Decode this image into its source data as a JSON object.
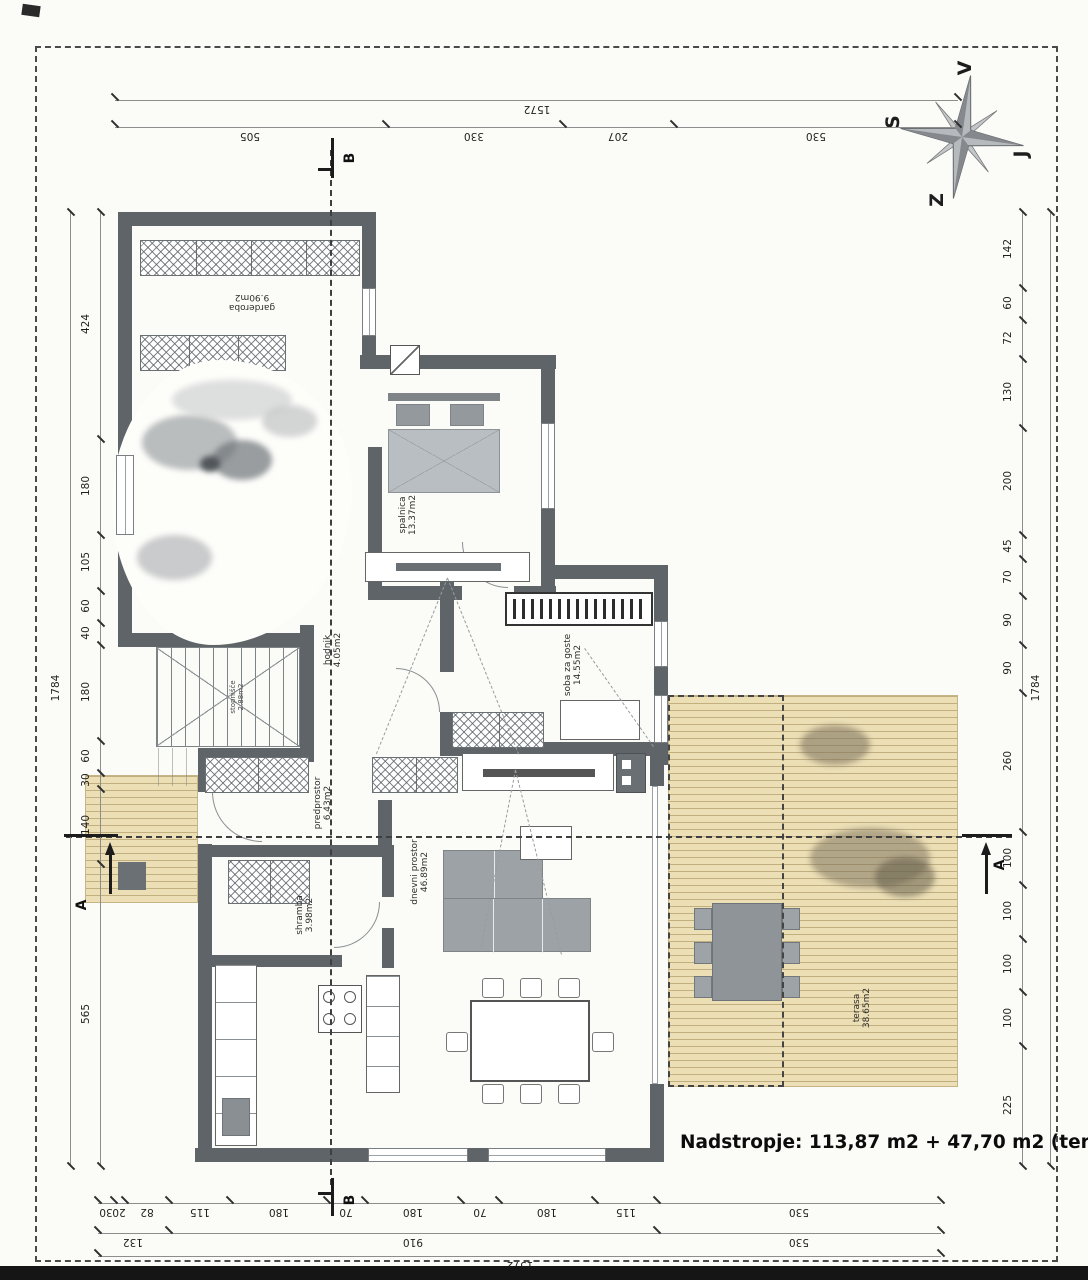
{
  "compass": {
    "v": "V",
    "s": "S",
    "j": "J",
    "z": "Z"
  },
  "dims": {
    "top_total": [
      "1572"
    ],
    "top": [
      "505",
      "330",
      "207",
      "530"
    ],
    "left_total": [
      "1784"
    ],
    "left": [
      "424",
      "180",
      "105",
      "60",
      "40",
      "180",
      "60",
      "30",
      "140",
      "565"
    ],
    "right": [
      "142",
      "60",
      "72",
      "130",
      "200",
      "45",
      "70",
      "90",
      "90",
      "260",
      "100",
      "100",
      "100",
      "100",
      "225"
    ],
    "right_total": [
      "1784"
    ],
    "bottom": [
      "30",
      "20",
      "82",
      "115",
      "180",
      "70",
      "180",
      "70",
      "180",
      "115",
      "530"
    ],
    "bottom_sub": [
      "132",
      "910",
      "530"
    ],
    "bottom_total": [
      "1572"
    ]
  },
  "sections": {
    "a": "A",
    "b": "B"
  },
  "rooms": {
    "garderoba": {
      "name": "garderoba",
      "area": "9.90m2"
    },
    "spalnica": {
      "name": "spalnica",
      "area": "13.37m2"
    },
    "hodnik": {
      "name": "hodnik",
      "area": "4.05m2"
    },
    "stopnisce": {
      "name": "stopnišče",
      "area": "2.88m2"
    },
    "soba": {
      "name": "soba za goste",
      "area": "14.55m2"
    },
    "predprostor": {
      "name": "predprostor",
      "area": "6.43m2"
    },
    "shramba": {
      "name": "shramba",
      "area": "3.98m2"
    },
    "dnevni": {
      "name": "dnevni prostor",
      "area": "46.89m2"
    },
    "terasa": {
      "name": "terasa",
      "area": "38.65m2"
    }
  },
  "summary": {
    "text": "Nadstropje: 113,87 m2 + 47,70 m2 (terasa)"
  },
  "colors": {
    "wall": "#5f6468",
    "furniture": "#9da2a6",
    "deck": "#ecdfb6",
    "paper": "#fbfcf7"
  }
}
